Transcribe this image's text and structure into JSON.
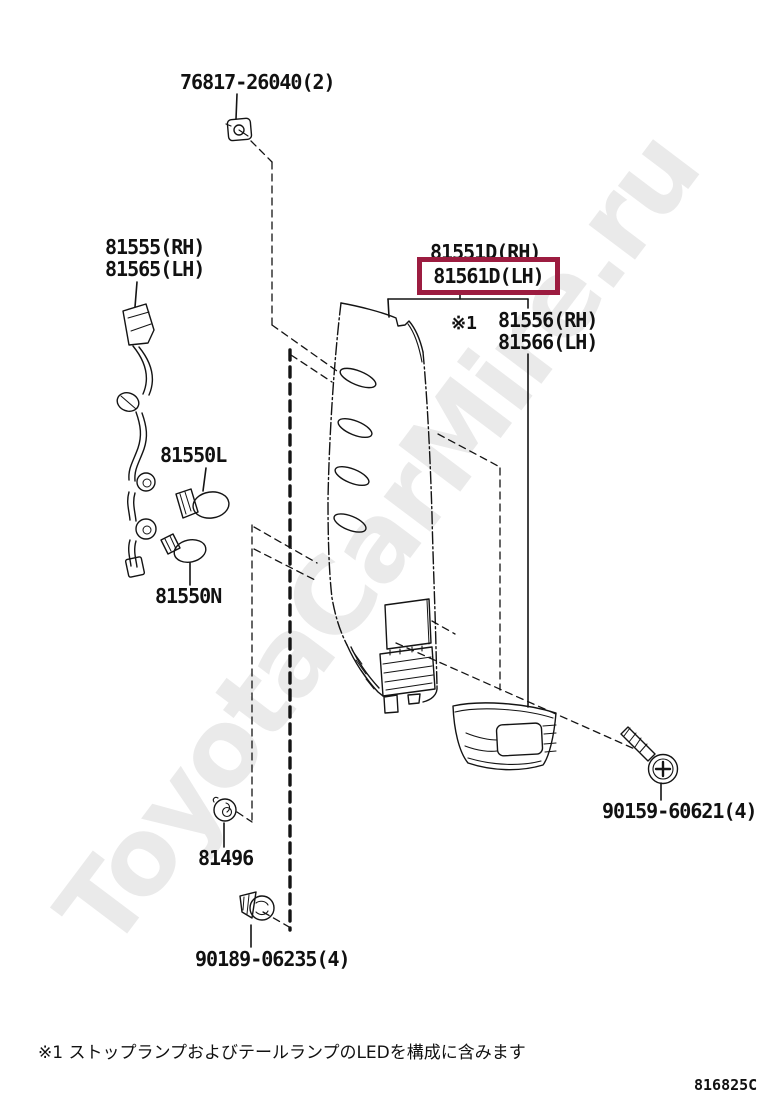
{
  "watermark": {
    "text": "ToyotaCarMire.ru"
  },
  "parts": {
    "clip_top": "76817-26040(2)",
    "harness_rh": "81555(RH)",
    "harness_lh": "81565(LH)",
    "pillar_rh": "81551D(RH)",
    "pillar_lh_highlighted": "81561D(LH)",
    "ref_marker": "※1",
    "lamp_rh": "81556(RH)",
    "lamp_lh": "81566(LH)",
    "bulb_l": "81550L",
    "bulb_n": "81550N",
    "grommet": "81496",
    "clip_bottom": "90189-06235(4)",
    "screw": "90159-60621(4)"
  },
  "footer": {
    "note": "※1 ストップランプおよびテールランプのLEDを構成に含みます",
    "code": "816825C"
  },
  "colors": {
    "highlight_box": "#9C1C40",
    "line": "#141414",
    "watermark": "#eaeaea"
  }
}
